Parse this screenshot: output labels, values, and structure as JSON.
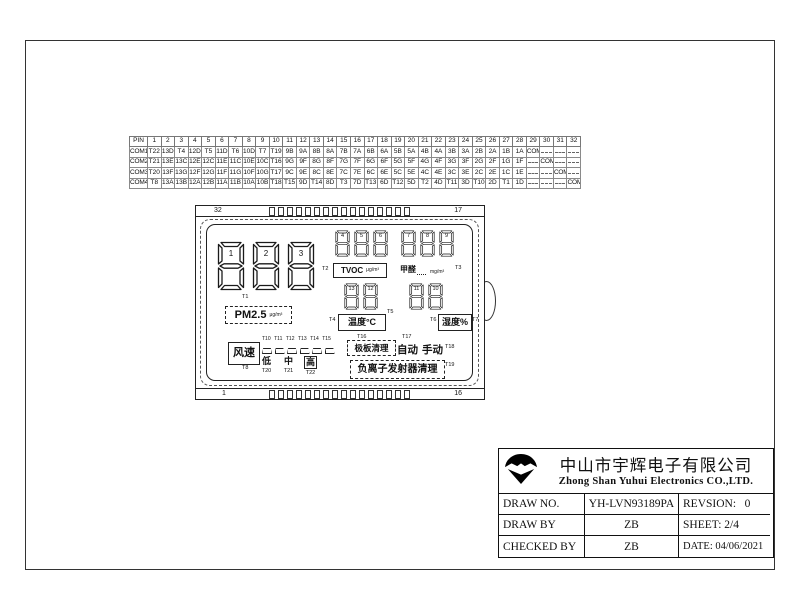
{
  "pin_table": {
    "header": [
      "PIN",
      "1",
      "2",
      "3",
      "4",
      "5",
      "6",
      "7",
      "8",
      "9",
      "10",
      "11",
      "12",
      "13",
      "14",
      "15",
      "16",
      "17",
      "18",
      "19",
      "20",
      "21",
      "22",
      "23",
      "24",
      "25",
      "26",
      "27",
      "28",
      "29",
      "30",
      "31",
      "32"
    ],
    "rows": [
      {
        "com": "COM1",
        "cells": [
          "T22",
          "13D",
          "T4",
          "12D",
          "T5",
          "11D",
          "T6",
          "10D",
          "T7",
          "T19",
          "9B",
          "9A",
          "8B",
          "8A",
          "7B",
          "7A",
          "6B",
          "6A",
          "5B",
          "5A",
          "4B",
          "4A",
          "3B",
          "3A",
          "2B",
          "2A",
          "1B",
          "1A",
          "COM1",
          "",
          "",
          ""
        ]
      },
      {
        "com": "COM2",
        "cells": [
          "T21",
          "13E",
          "13C",
          "12E",
          "12C",
          "11E",
          "11C",
          "10E",
          "10C",
          "T16",
          "9G",
          "9F",
          "8G",
          "8F",
          "7G",
          "7F",
          "6G",
          "6F",
          "5G",
          "5F",
          "4G",
          "4F",
          "3G",
          "3F",
          "2G",
          "2F",
          "1G",
          "1F",
          "",
          "COM2",
          "",
          ""
        ]
      },
      {
        "com": "COM3",
        "cells": [
          "T20",
          "13F",
          "13G",
          "12F",
          "12G",
          "11F",
          "11G",
          "10F",
          "10G",
          "T17",
          "9C",
          "9E",
          "8C",
          "8E",
          "7C",
          "7E",
          "6C",
          "6E",
          "5C",
          "5E",
          "4C",
          "4E",
          "3C",
          "3E",
          "2C",
          "2E",
          "1C",
          "1E",
          "",
          "",
          "COM3",
          ""
        ]
      },
      {
        "com": "COM4",
        "cells": [
          "T8",
          "13A",
          "13B",
          "12A",
          "12B",
          "11A",
          "11B",
          "10A",
          "10B",
          "T18",
          "T15",
          "9D",
          "T14",
          "8D",
          "T3",
          "7D",
          "T13",
          "6D",
          "T12",
          "5D",
          "T2",
          "4D",
          "T11",
          "3D",
          "T10",
          "2D",
          "T1",
          "1D",
          "",
          "",
          "",
          "COM4"
        ]
      }
    ]
  },
  "lcd": {
    "corners": {
      "top_left": "32",
      "top_right": "17",
      "bottom_left": "1",
      "bottom_right": "16"
    },
    "big_digits": [
      "1",
      "2",
      "3"
    ],
    "pm25": {
      "t": "T1",
      "label": "PM2.5",
      "unit": "μg/m³"
    },
    "tvoc": {
      "digits": [
        "4",
        "5",
        "6"
      ],
      "t_left": "T2",
      "label": "TVOC",
      "unit": "μg/m³"
    },
    "hcho": {
      "digits": [
        "7",
        "8",
        "9"
      ],
      "label": "甲醛",
      "unit": "mg/m³",
      "t_right": "T3"
    },
    "temp": {
      "digits": [
        "13",
        "12"
      ],
      "t_left": "T4",
      "label": "温度°C",
      "t_right": "T5"
    },
    "humid": {
      "digits": [
        "11",
        "10"
      ],
      "t_left": "T6",
      "label": "湿度%",
      "t_right": "T7"
    },
    "fan": {
      "label": "风速",
      "t": "T8",
      "bar_ts": [
        "T10",
        "T11",
        "T12",
        "T13",
        "T14",
        "T15"
      ],
      "levels": [
        {
          "text": "低",
          "t": "T20",
          "boxed": false
        },
        {
          "text": "中",
          "t": "T21",
          "boxed": false
        },
        {
          "text": "高",
          "t": "T22",
          "boxed": true
        }
      ]
    },
    "plate": {
      "t": "T16",
      "label": "极板清理",
      "auto_t": "T17",
      "auto": "自动",
      "manual": "手动",
      "manual_t": "T18"
    },
    "ion": {
      "label": "负离子发射器清理",
      "t": "T19"
    }
  },
  "title_block": {
    "company_cn": "中山市宇辉电子有限公司",
    "company_en": "Zhong Shan Yuhui Electronics CO.,LTD.",
    "rows": [
      {
        "label": "DRAW NO.",
        "value": "YH-LVN93189PA",
        "right": "REVSION:   0"
      },
      {
        "label": "DRAW BY",
        "value": "ZB",
        "right": "SHEET: 2/4"
      },
      {
        "label": "CHECKED BY",
        "value": "ZB",
        "right": "DATE: 04/06/2021"
      }
    ]
  }
}
